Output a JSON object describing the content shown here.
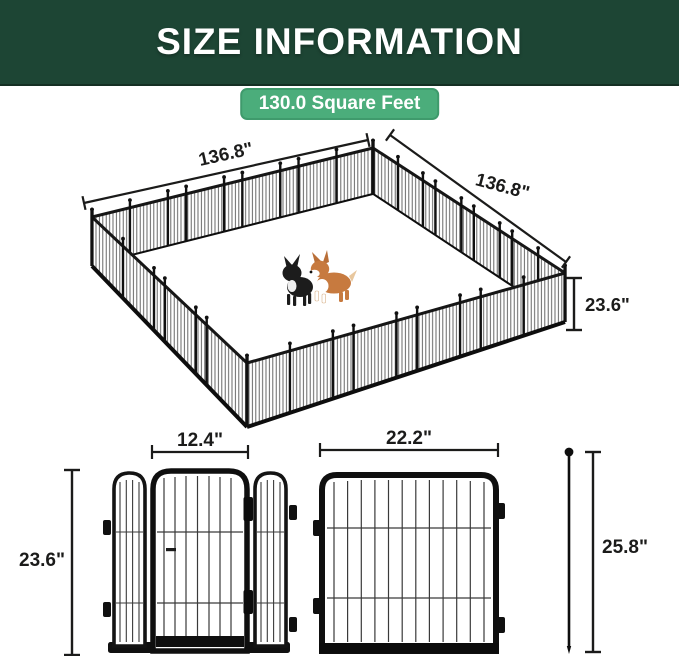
{
  "header": {
    "title": "SIZE INFORMATION"
  },
  "badge": {
    "label": "130.0 Square Feet"
  },
  "playpen": {
    "left_width_label": "136.8\"",
    "right_width_label": "136.8\"",
    "height_label": "23.6\"",
    "area_label": "130.0 Square Feet"
  },
  "door_section": {
    "door_width_label": "12.4\"",
    "panel_height_label": "23.6\""
  },
  "panel_section": {
    "panel_width_label": "22.2\""
  },
  "stake_section": {
    "stake_height_label": "25.8\""
  },
  "colors": {
    "header_bg": "#1d4534",
    "badge_green": "#4bad7b",
    "frame_black": "#101010",
    "dimension_dark": "#1b1b1a",
    "corgi_tan": "#c77a3f"
  }
}
